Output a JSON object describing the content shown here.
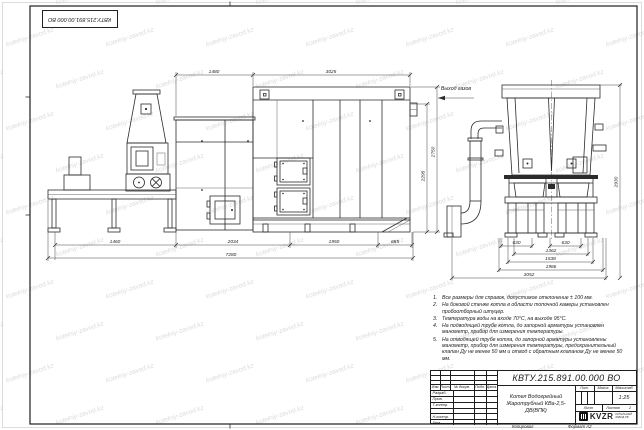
{
  "watermark": {
    "text": "kotelniy-zavod.kz"
  },
  "stamp": {
    "doc_number": "КВТУ.215.891.00.000 ВО"
  },
  "views": {
    "gas_outlet_label": "Выход газов"
  },
  "dims": {
    "front_top_1": "1480",
    "front_top_2": "3025",
    "front_bottom_1": "1460",
    "front_bottom_2": "2034",
    "front_bottom_3": "1950",
    "front_bottom_4": "685",
    "front_overall": "7280",
    "front_height_outer": "2750",
    "front_height_inner": "2295",
    "side_b1": "630",
    "side_b2": "630",
    "side_b3": "1362",
    "side_b4": "1538",
    "side_b5": "1986",
    "side_b6": "3052",
    "side_height": "2930"
  },
  "notes": {
    "items": [
      {
        "num": "1.",
        "text": "Все размеры для справок, допустимое отклонение ± 100 мм."
      },
      {
        "num": "2.",
        "text": "На боковой стенке котла в области топочной камеры установлен пробоотборный штуцер."
      },
      {
        "num": "3.",
        "text": "Температура воды на входе 70°С, на выходе 95°С."
      },
      {
        "num": "4.",
        "text": "На подводящей трубе котла, до запорной арматуры установлен манометр, прибор для измерения температуры."
      },
      {
        "num": "5.",
        "text": "На отводящей трубе котла, до запорной арматуры установлены манометр, прибор для измерения температуры, предохранительный клапан Ду не менее 50 мм и отвод с обратным клапаном Ду не менее 50 мм."
      }
    ]
  },
  "title_block": {
    "doc_number": "КВТУ.215.891.00.000 ВО",
    "product_name_1": "Котел Водогрейный",
    "product_name_2": "Жаротрубный КВа-2,5-ДВ(ВПК)",
    "col_izm": "Изм.",
    "col_list": "Лист",
    "col_doc": "№ докум.",
    "col_podp": "Подп.",
    "col_data": "Дата",
    "rows": [
      "Разраб.",
      "Пров.",
      "Т.контр.",
      "",
      "Н.контр.",
      "Утв."
    ],
    "lit_label": "Лит.",
    "mass_label": "Масса",
    "scale_label": "Масштаб",
    "scale_value": "1:25",
    "sheet_label": "Лист",
    "sheets_label": "Листов",
    "sheets_value": "2",
    "logo_text": "KVZR",
    "logo_sub1": "КОТЕЛЬНЫЙ",
    "logo_sub2": "ЗАВОД РФ",
    "copied_label": "Копировал",
    "format_label": "Формат А2"
  }
}
